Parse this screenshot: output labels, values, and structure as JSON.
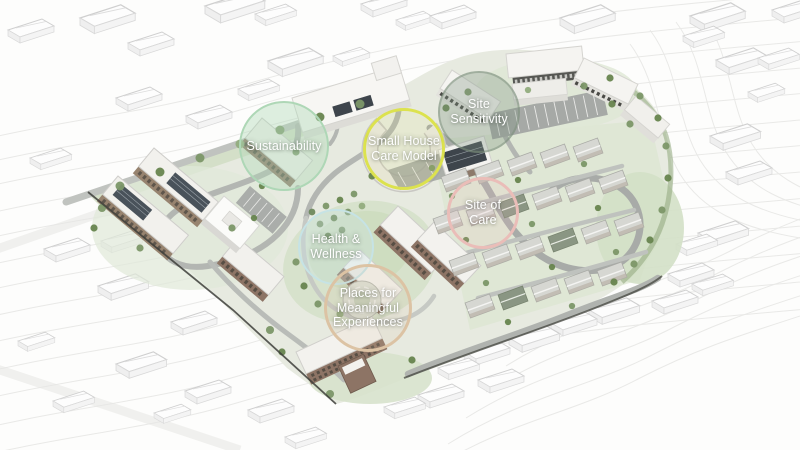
{
  "figure": {
    "kind": "Architectural masterplan aerial rendering",
    "description": "Axonometric site plan of a campus with six design-concept annotation circles over the rendering"
  },
  "annotations": [
    {
      "id": "sustainability",
      "label": "Sustainability",
      "cx": 284,
      "cy": 146,
      "r": 45,
      "ring_color": "#aed7b6",
      "fill_color": "rgba(176,216,184,0.42)",
      "ring_width": 2
    },
    {
      "id": "small-house-care-model",
      "label": "Small House\nCare Model",
      "cx": 404,
      "cy": 149,
      "r": 41,
      "ring_color": "#dce24e",
      "fill_color": "rgba(223,229,90,0.10)",
      "ring_width": 3
    },
    {
      "id": "site-sensitivity",
      "label": "Site\nSensitivity",
      "cx": 479,
      "cy": 112,
      "r": 41,
      "ring_color": "rgba(124,143,124,0.50)",
      "fill_color": "rgba(124,146,126,0.32)",
      "ring_width": 2
    },
    {
      "id": "site-of-care",
      "label": "Site of\nCare",
      "cx": 483,
      "cy": 213,
      "r": 36,
      "ring_color": "#eabdb8",
      "fill_color": "rgba(234,189,184,0.16)",
      "ring_width": 3
    },
    {
      "id": "health-and-wellness",
      "label": "Health &\nWellness",
      "cx": 336,
      "cy": 247,
      "r": 38,
      "ring_color": "#c6e3e5",
      "fill_color": "rgba(203,229,231,0.30)",
      "ring_width": 2
    },
    {
      "id": "places-for-meaningful-experiences",
      "label": "Places for\nMeaningful\nExperiences",
      "cx": 368,
      "cy": 308,
      "r": 44,
      "ring_color": "#dcc3a4",
      "fill_color": "rgba(220,195,164,0.16)",
      "ring_width": 3
    }
  ],
  "palette": {
    "background": "#fdfdfc",
    "contour_line": "#e7e7e5",
    "context_building": "#fbfbfa",
    "site_ground": "#e7eae0",
    "landscape_green": "#d7e2cc",
    "road_gray": "#a8aba8",
    "brick_wall": "#8d7465",
    "roof_white": "#f3f2ee",
    "solar_panel": "#3e454c",
    "tree_green": "#7d9769",
    "boundary_dark": "#3d3e3a"
  }
}
